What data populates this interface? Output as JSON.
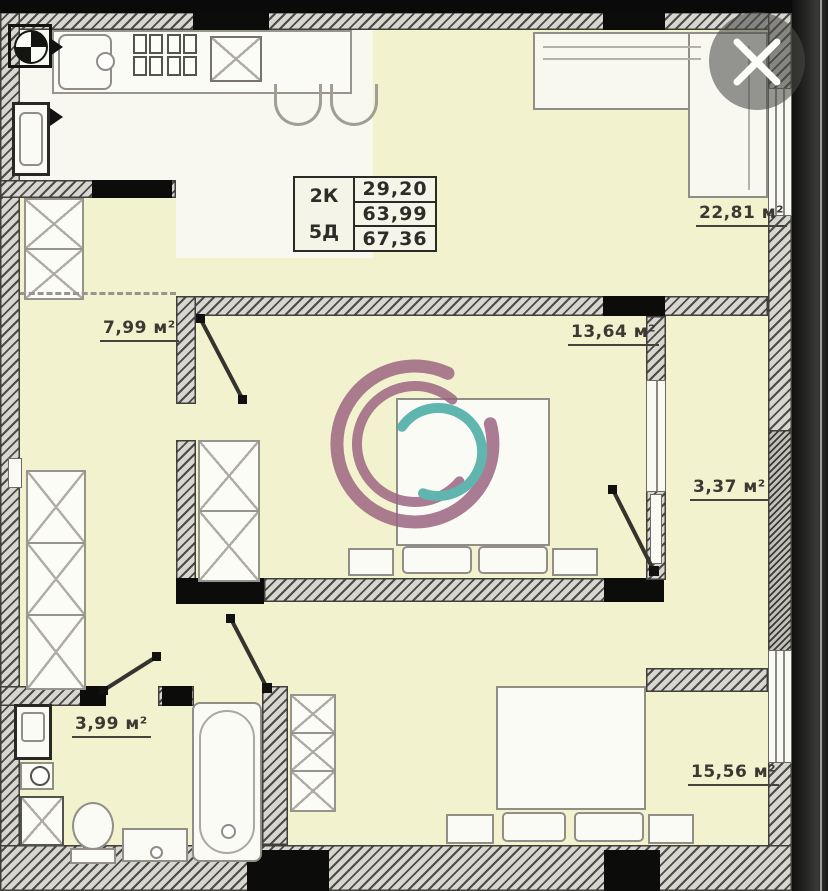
{
  "info_table": {
    "col1": [
      "2К",
      "5Д"
    ],
    "col2": [
      "29,20",
      "63,99",
      "67,36"
    ]
  },
  "room_labels": {
    "living_kitchen": "22,81 м²",
    "hall": "7,99 м²",
    "bedroom_1": "13,64 м²",
    "loggia": "3,37 м²",
    "bathroom": "3,99 м²",
    "bedroom_2": "15,56 м²"
  },
  "close_button": {
    "icon": "close-x"
  },
  "watermark": {
    "purple": "#99617f",
    "teal": "#3fa79f"
  },
  "colors": {
    "floor_cream": "#f3f2cf",
    "floor_white": "#f8f8f1",
    "wall_fill": "#d7d6d1",
    "wall_line": "#4d4b46",
    "black_wall": "#0c0c0b",
    "photo_black": "#0a0a0a"
  }
}
